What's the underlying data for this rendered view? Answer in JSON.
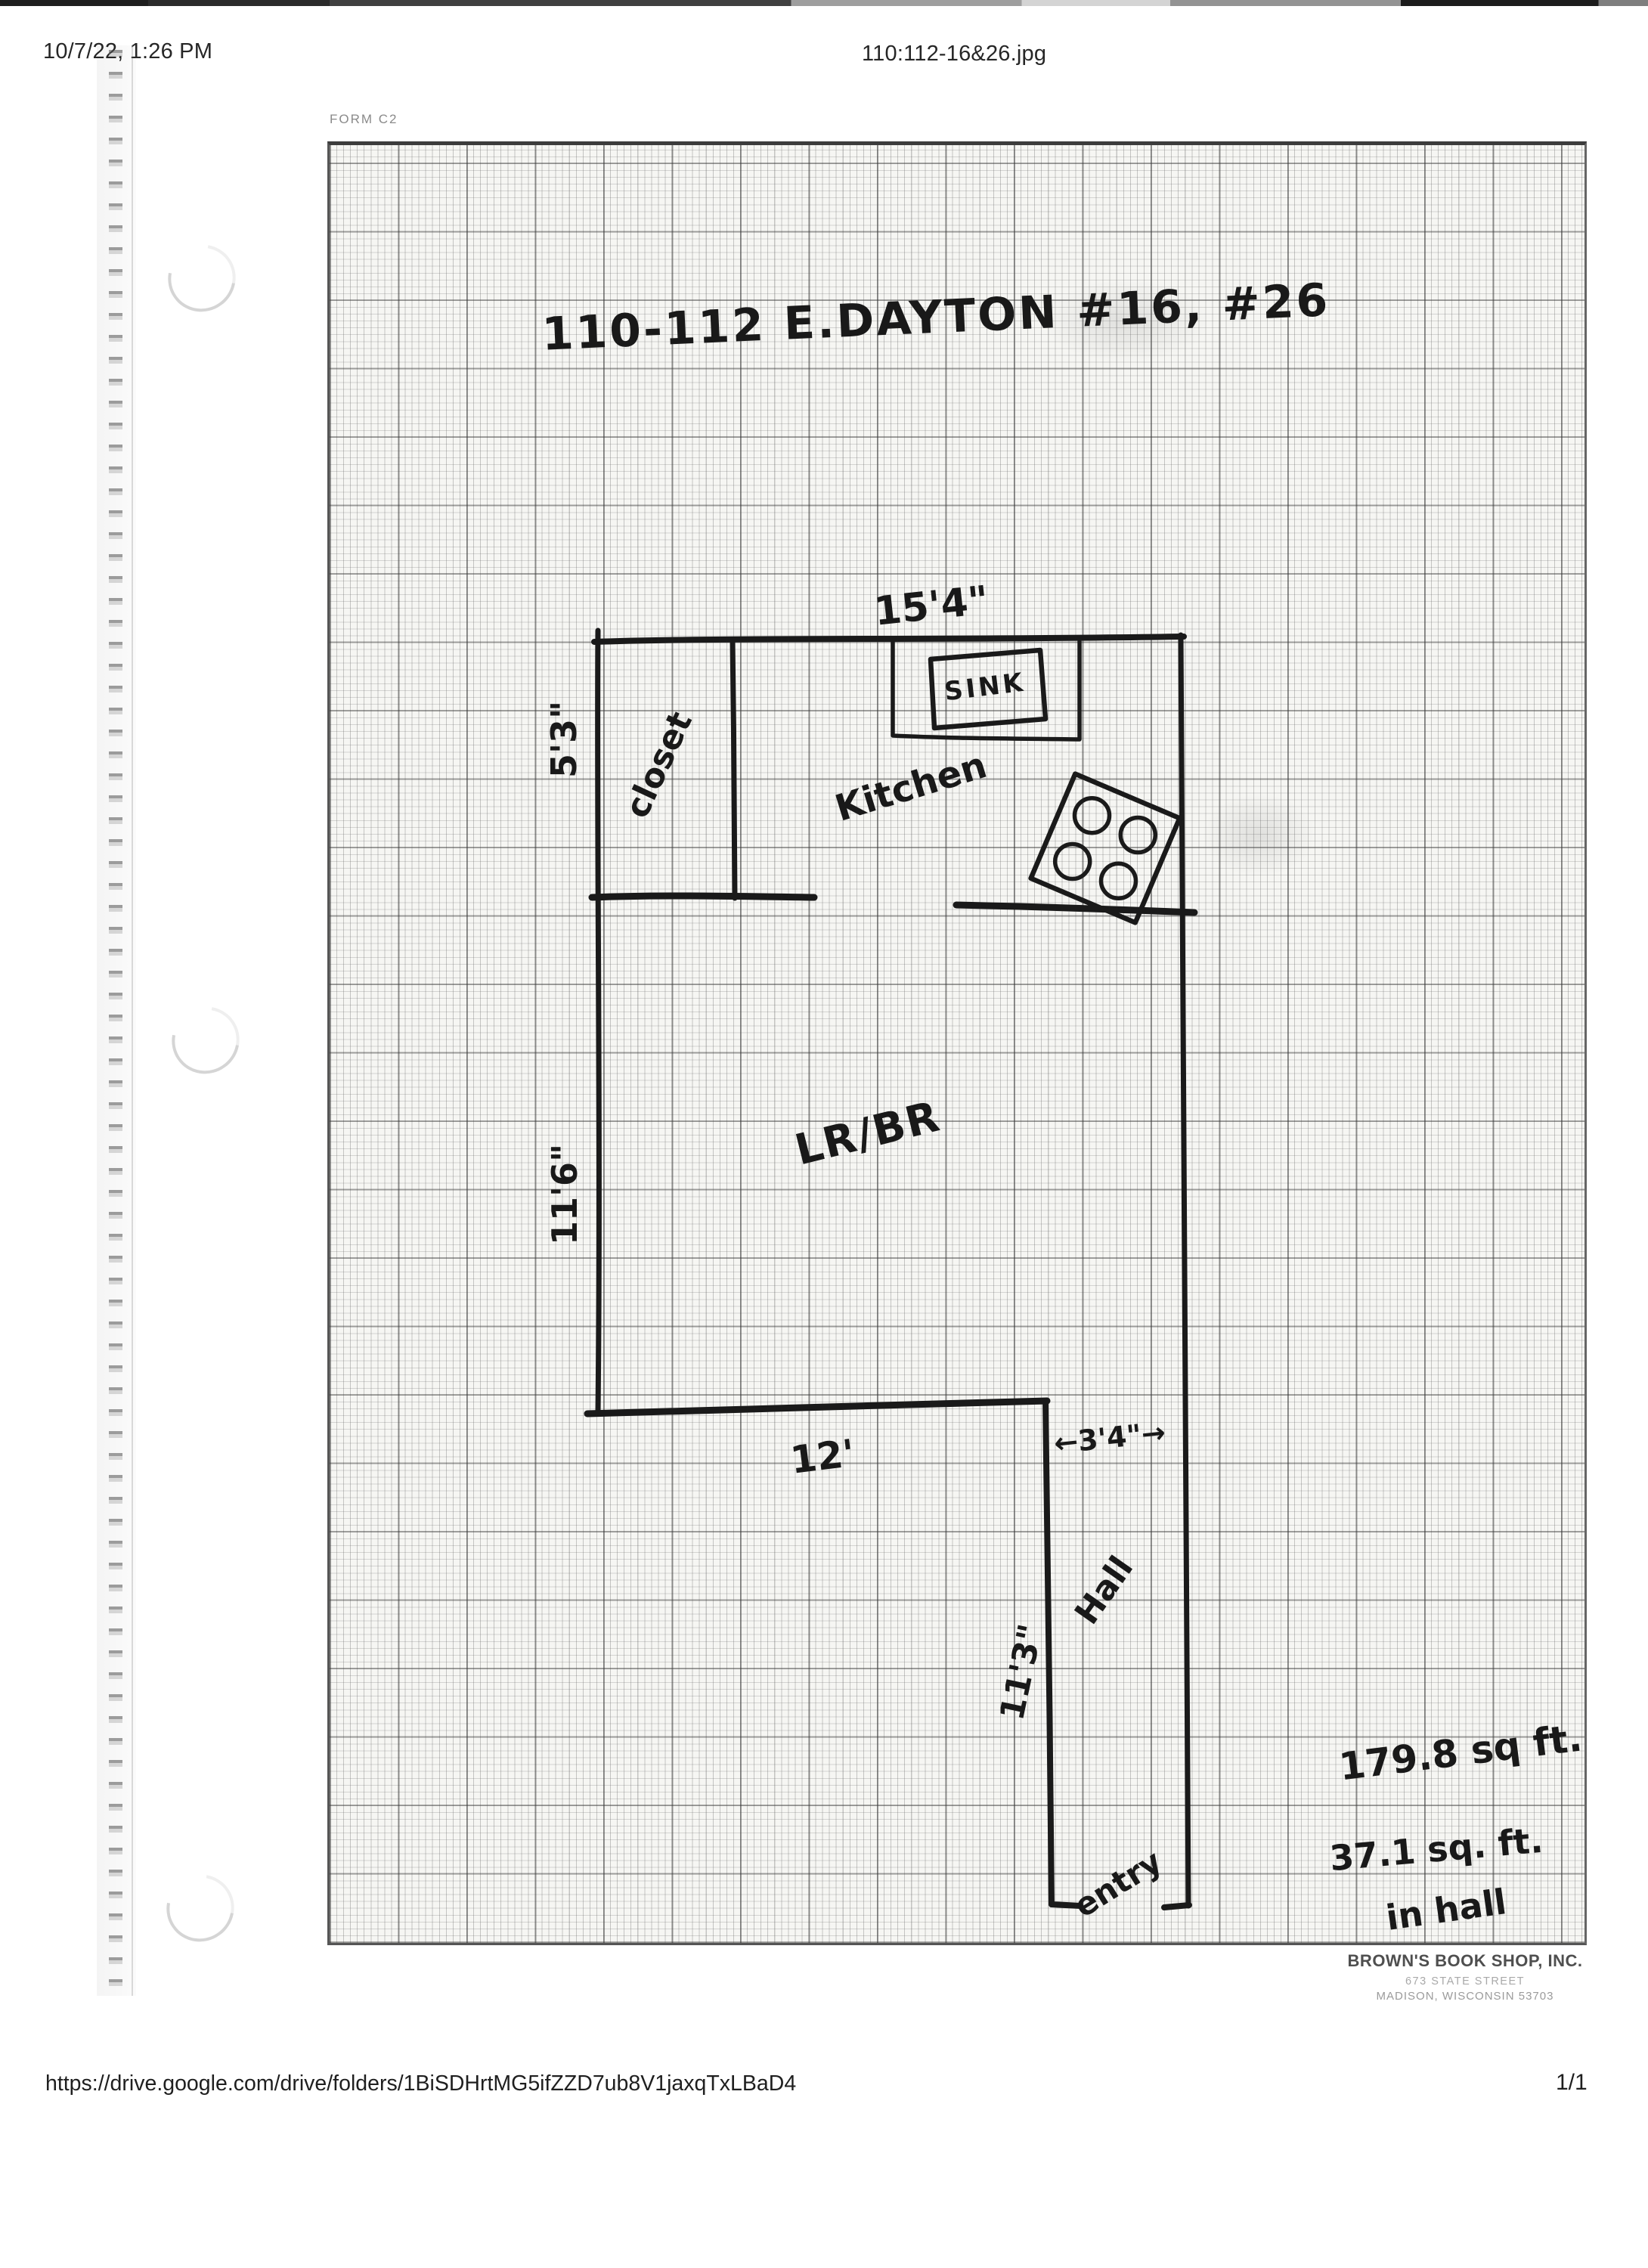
{
  "header": {
    "timestamp": "10/7/22, 1:26 PM",
    "filename": "110:112-16&26.jpg"
  },
  "paper": {
    "form_label": "FORM C2"
  },
  "floorplan": {
    "title": "110-112 E.DAYTON  #16, #26",
    "rooms": {
      "kitchen": "Kitchen",
      "closet": "closet",
      "living": "LR/BR",
      "hall": "Hall",
      "entry": "entry"
    },
    "fixtures": {
      "sink": "SINK"
    },
    "dimensions": {
      "kitchen_width": "15'4\"",
      "closet_height": "5'3\"",
      "living_height": "11'6\"",
      "living_width": "12'",
      "hall_width": "←3'4\"→",
      "hall_height": "11'3\""
    },
    "area_notes": {
      "line1": "179.8 sq ft.",
      "line2": "37.1 sq. ft.",
      "line3": "in hall"
    }
  },
  "stamp": {
    "name": "BROWN'S BOOK SHOP, INC.",
    "address1": "673 STATE STREET",
    "address2": "MADISON, WISCONSIN 53703"
  },
  "footer": {
    "url": "https://drive.google.com/drive/folders/1BiSDHrtMG5ifZZD7ub8V1jaxqTxLBaD4",
    "page": "1/1"
  }
}
